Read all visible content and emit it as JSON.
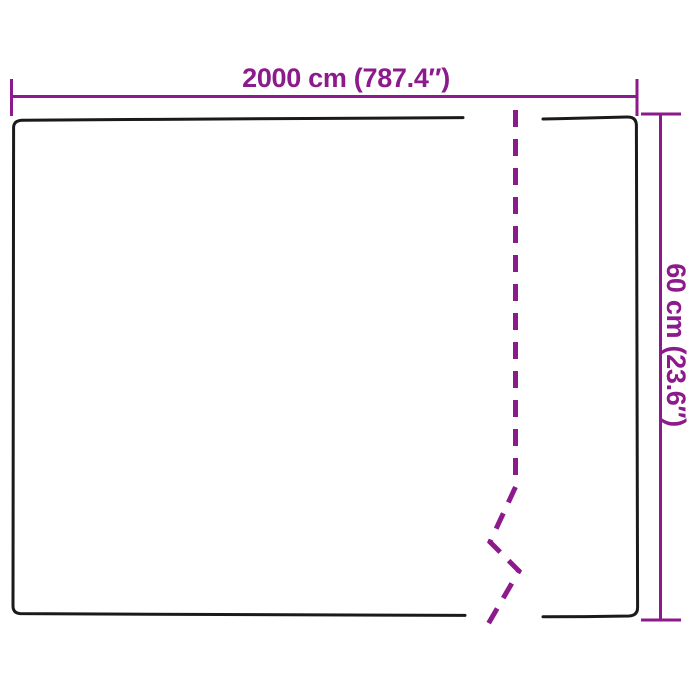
{
  "diagram": {
    "kind": "product-dimension-diagram",
    "width_label": "2000 cm (787.4″)",
    "height_label": "60 cm (23.6″)",
    "colors": {
      "dimension": "#8C1A8C",
      "outline": "#1A1A1A",
      "background": "#FFFFFF"
    }
  }
}
